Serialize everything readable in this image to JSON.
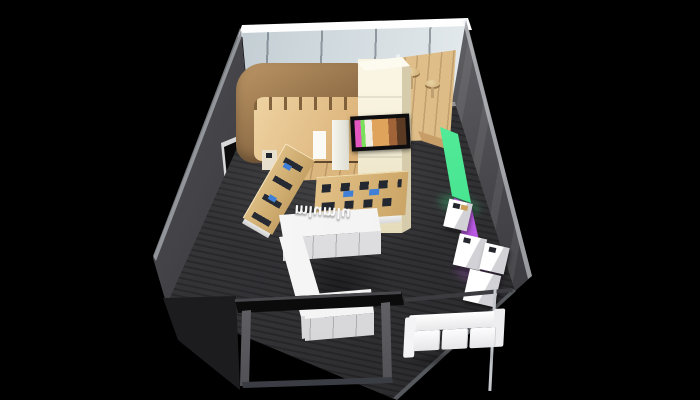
{
  "scene": {
    "type": "3d-render",
    "description": "Isometric 3D rendering of a small retail store interior on a black background",
    "logo": {
      "text": "mlumlu"
    },
    "colors": {
      "background": "#000000",
      "carpet": "#313134",
      "fascia": "#f4f6f7",
      "glass": "#c7d1d7",
      "wood_dark": "#8f6d46",
      "wood_mid": "#cda263",
      "wood_light": "#e7c795",
      "cream": "#f0e9cf",
      "counter": "#f4f4f5",
      "sofa": "#fafafa",
      "panel_green": "#2bd57b",
      "panel_purple": "#a743d6",
      "tv_frame": "#0d0d0f",
      "screen_blue": "#3f7fd6"
    },
    "objects": [
      {
        "id": "fascia",
        "label": "White fascia band"
      },
      {
        "id": "glass-wall",
        "label": "Back glass wall"
      },
      {
        "id": "left-wall",
        "label": "Left wall"
      },
      {
        "id": "niche",
        "label": "Wall display niche"
      },
      {
        "id": "right-wall",
        "label": "Right wall"
      },
      {
        "id": "floor",
        "label": "Dark carpet floor"
      },
      {
        "id": "wood-zone",
        "label": "Wooden floor area"
      },
      {
        "id": "nook",
        "label": "Cafe nook with wooden floor and stools"
      },
      {
        "id": "canopy",
        "label": "Curved wooden canopy"
      },
      {
        "id": "column",
        "label": "Illuminated media column"
      },
      {
        "id": "tv",
        "label": "Wall-mounted TV screen"
      },
      {
        "id": "table-long",
        "label": "Long wooden display table with devices"
      },
      {
        "id": "table-center",
        "label": "Central wooden demo table with devices"
      },
      {
        "id": "panel-green",
        "label": "Green illuminated wall panel"
      },
      {
        "id": "panel-purple",
        "label": "Purple illuminated wall panel"
      },
      {
        "id": "pedestals",
        "label": "White display pedestals"
      },
      {
        "id": "counter",
        "label": "White U-shaped service counter"
      },
      {
        "id": "logo",
        "label": "3D brand letters on counter"
      },
      {
        "id": "entrance",
        "label": "Glass entrance frame"
      },
      {
        "id": "sofa",
        "label": "White three-seat sofa"
      }
    ]
  }
}
